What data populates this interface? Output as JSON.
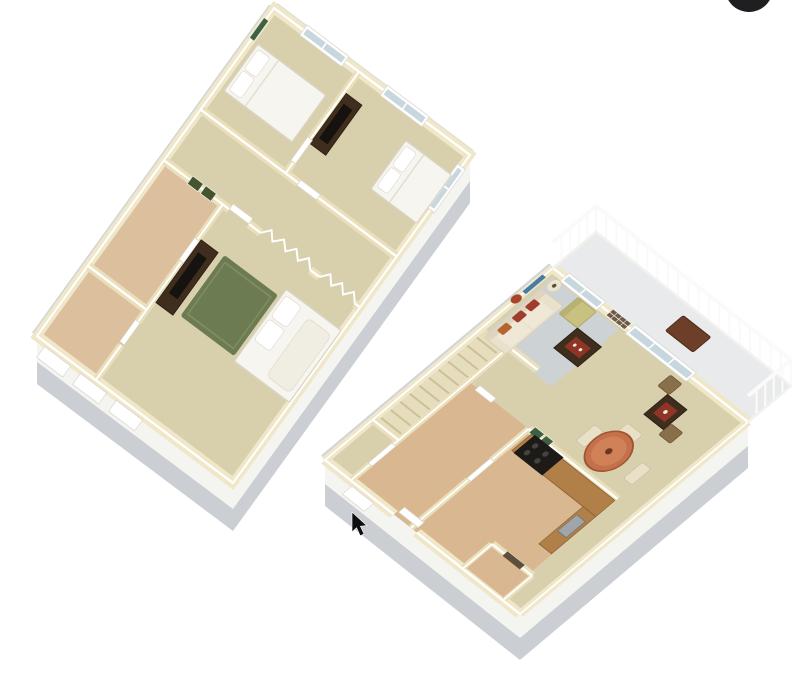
{
  "scene": {
    "width": 800,
    "height": 681,
    "background": "#ffffff",
    "description": "3D dollhouse-view floor plan rendering of a two-story apartment: upstairs bedroom level shown at top left, downstairs living level with balcony shown at bottom right, on a plain white background",
    "cursor": "black arrow pointer near the lower floor entry wall",
    "corner_element": "black circular element clipped at the top edge near the top-right corner"
  },
  "colors": {
    "background": "#ffffff",
    "base_gray": "#cbced2",
    "band_white": "#f4f4f1",
    "wall_cream": "#f0e7c8",
    "wall_cream_deep": "#e9dfba",
    "floor_carpet": "#d8d0ad",
    "floor_tan": "#dcbf9c",
    "floor_tile": "#d9b891",
    "stair_floor": "#e6ddbd",
    "glass_blue": "#c8d7dd",
    "bed_white": "#f7f5ef",
    "throw_white": "#f0ede3",
    "wood_dark": "#3f2d1d",
    "tv_black": "#15120f",
    "rug_green": "#6d7b53",
    "rug_blue": "#cdd3d5",
    "sofa_cream": "#eae1cd",
    "sofa_trim": "#dfd5bf",
    "cushion_cream": "#f0e8d6",
    "pillow_red": "#a03b2d",
    "pillow_orange": "#b5652f",
    "chair_yellow": "#c9c180",
    "chair_yellow_dark": "#b9b172",
    "tray_red": "#8e3526",
    "table_terracotta": "#c4714b",
    "table_terracotta_light": "#d08157",
    "chair_cream": "#e9e0c8",
    "wicker": "#8a6f4b",
    "wood_oak": "#b08048",
    "appliance_black": "#1d1a17",
    "sink_gray": "#9fa5a8",
    "balcony_floor": "#e9eaec",
    "bench_brown": "#6e3f28",
    "art_blue": "#4a7ba0",
    "art_red": "#a7442c",
    "art_green": "#3f6141",
    "frame_olive": "#44542f",
    "frame_brown": "#6e5c49",
    "cursor_black": "#0e0e0e",
    "corner_button_black": "#1f1f22"
  },
  "upper_floor": {
    "name": "Upper floor - bedroom level",
    "rooms": [
      "bedroom-1",
      "bedroom-2",
      "hallway-landing",
      "master-bedroom",
      "left-room-a",
      "left-room-b"
    ],
    "furniture": [
      "bed-1-white-with-pillows",
      "green-wall-art",
      "tv-dresser-bedroom-2",
      "bed-2-white",
      "master-tv-dresser",
      "green-area-rug",
      "master-bed-with-throw",
      "hall-picture-frames",
      "bifold-closet-doors",
      "white-interior-doors"
    ],
    "openings": [
      "two top-wall windows",
      "right-wall window",
      "three exterior windows on lower-left wall band"
    ]
  },
  "lower_floor": {
    "name": "Lower floor - living level",
    "rooms": [
      "living-room",
      "dining-area",
      "kitchen",
      "entry-hall",
      "staircase",
      "storage-vestibule",
      "balcony"
    ],
    "furniture": [
      "sofa-with-red-pillows",
      "coffee-table-with-red-tray",
      "accent-armchair",
      "floor-lamp",
      "blue-gray-area-rug",
      "round-dining-table",
      "four-dining-chairs",
      "game-table-with-red-tray",
      "two-wicker-chairs",
      "kitchen-counters",
      "black-range",
      "sink",
      "balcony-bench",
      "blue-wall-art",
      "red-round-wall-art",
      "picture-grid",
      "green-wall-frames",
      "white-interior-doors"
    ],
    "openings": [
      "double window near corner",
      "sliding-glass-door-to-balcony",
      "entry-door on lower-left wall",
      "exterior window on lower-left wall band"
    ]
  }
}
